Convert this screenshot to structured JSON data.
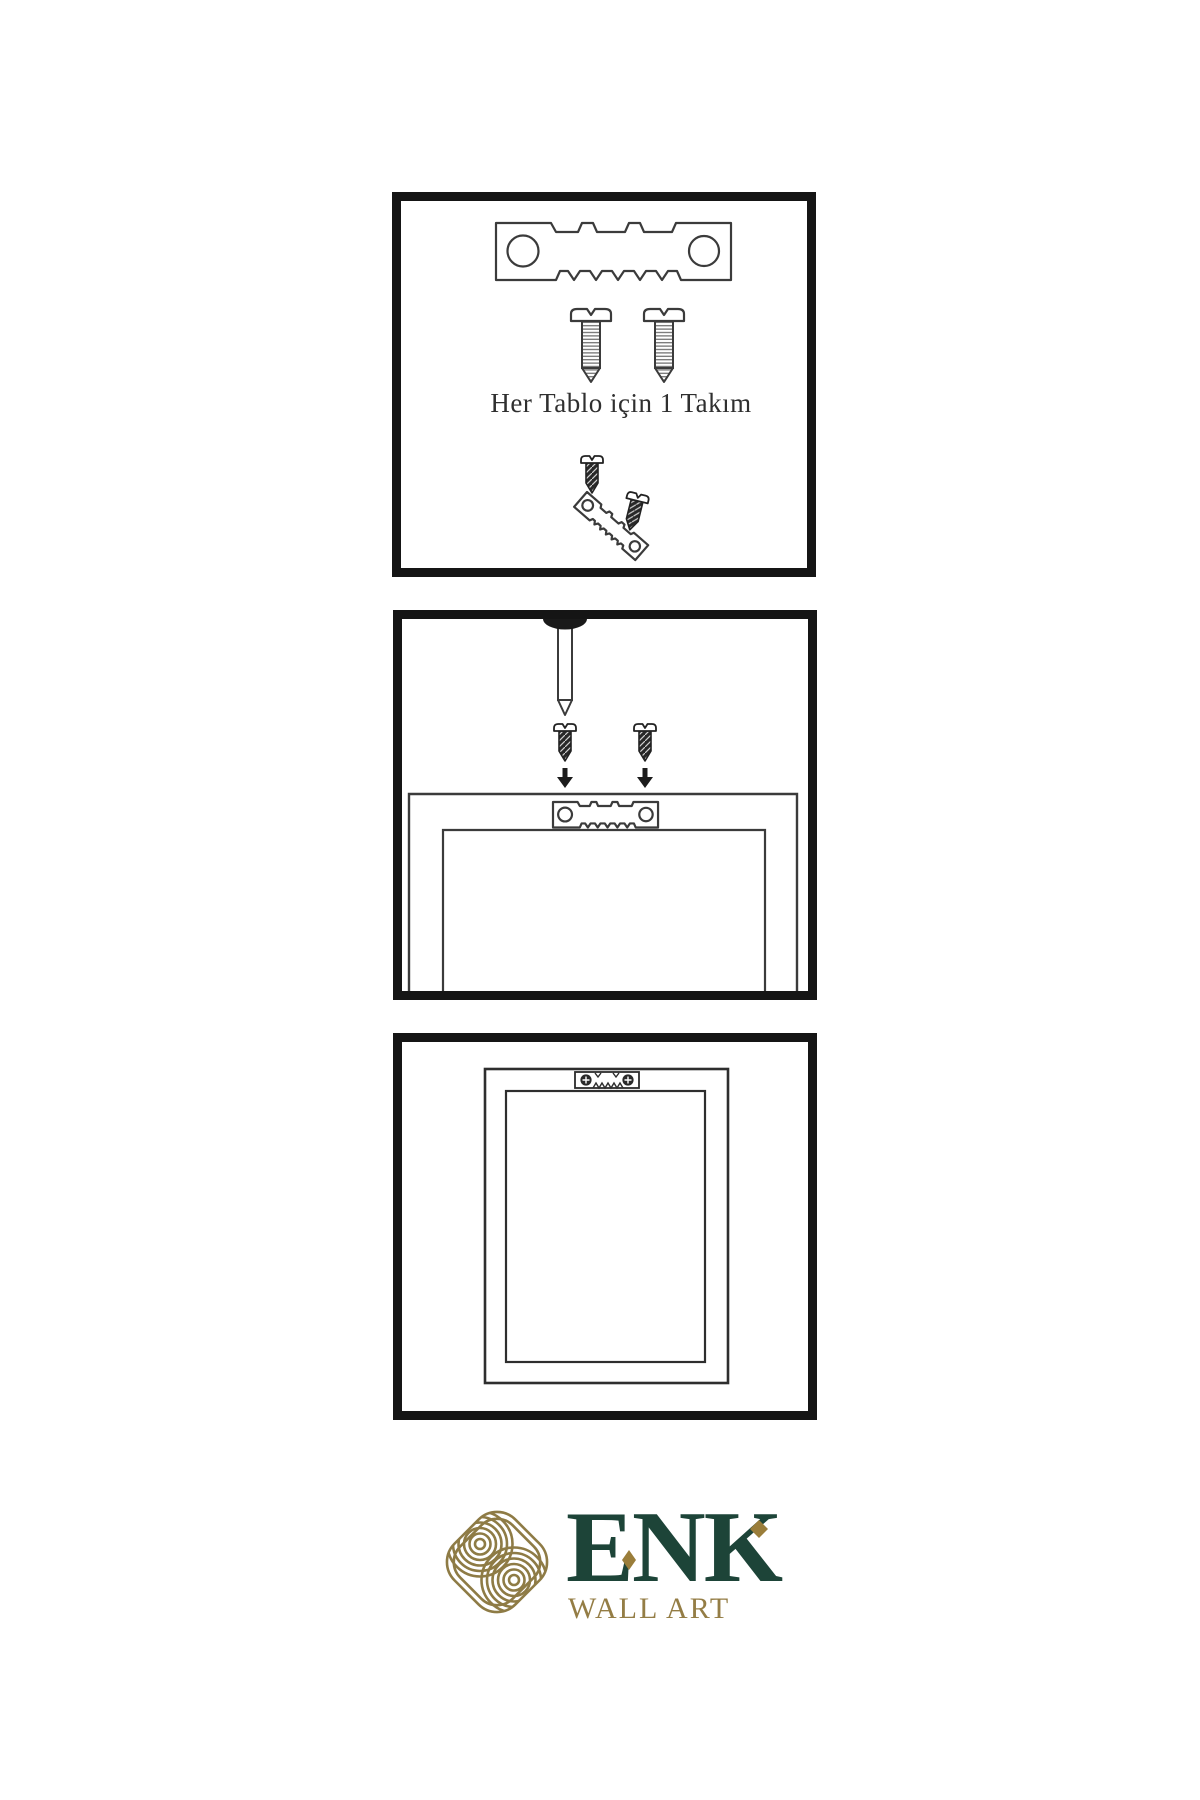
{
  "canvas": {
    "width": 1200,
    "height": 1800,
    "background": "#ffffff"
  },
  "colors": {
    "panel_border": "#151515",
    "drawing_line": "#3b3b3b",
    "dark_fill": "#262626",
    "brand_green": "#1d4438",
    "brand_gold": "#947d45",
    "diamond_gold": "#9a7d3a"
  },
  "kit_panel": {
    "caption": "Her Tablo için 1 Takım"
  },
  "brand": {
    "name": "ENK",
    "tagline": "WALL ART"
  }
}
